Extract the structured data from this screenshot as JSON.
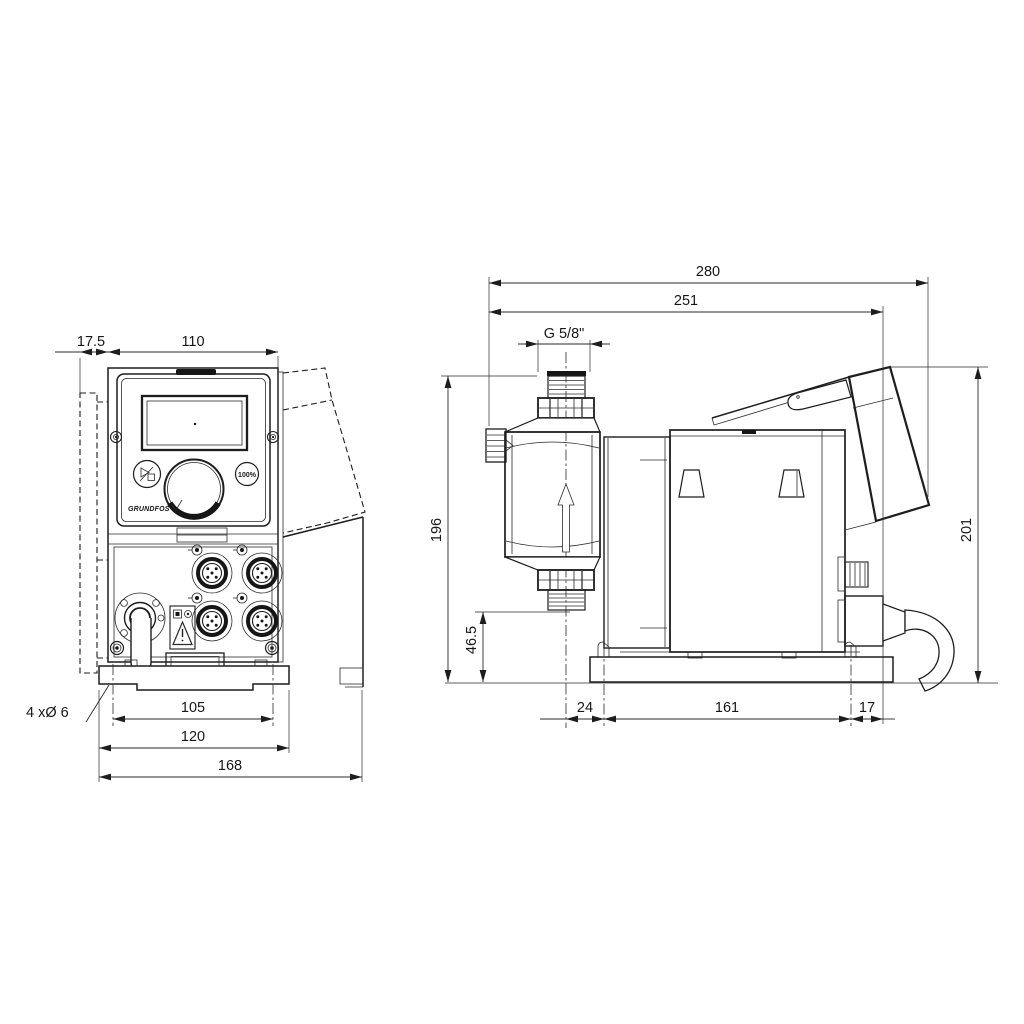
{
  "drawing": {
    "kind": "technical dimensional drawing, dosing pump, front and side views",
    "ink_color": "#1d1d1d",
    "background_color": "#ffffff"
  },
  "panel": {
    "brand": "GRUNDFOS",
    "btn_max": "100%"
  },
  "dims": {
    "front": {
      "offset": "17.5",
      "width": "110",
      "holes_span": "105",
      "plate_width": "120",
      "total_width": "168",
      "holes_note": "4 xØ 6"
    },
    "side": {
      "total_length": "280",
      "length_no_cable": "251",
      "inlet_thread": "G 5/8\"",
      "height": "196",
      "valve_height": "46.5",
      "panel_height": "201",
      "base_front": "24",
      "base_span": "161",
      "base_rear": "17"
    }
  }
}
